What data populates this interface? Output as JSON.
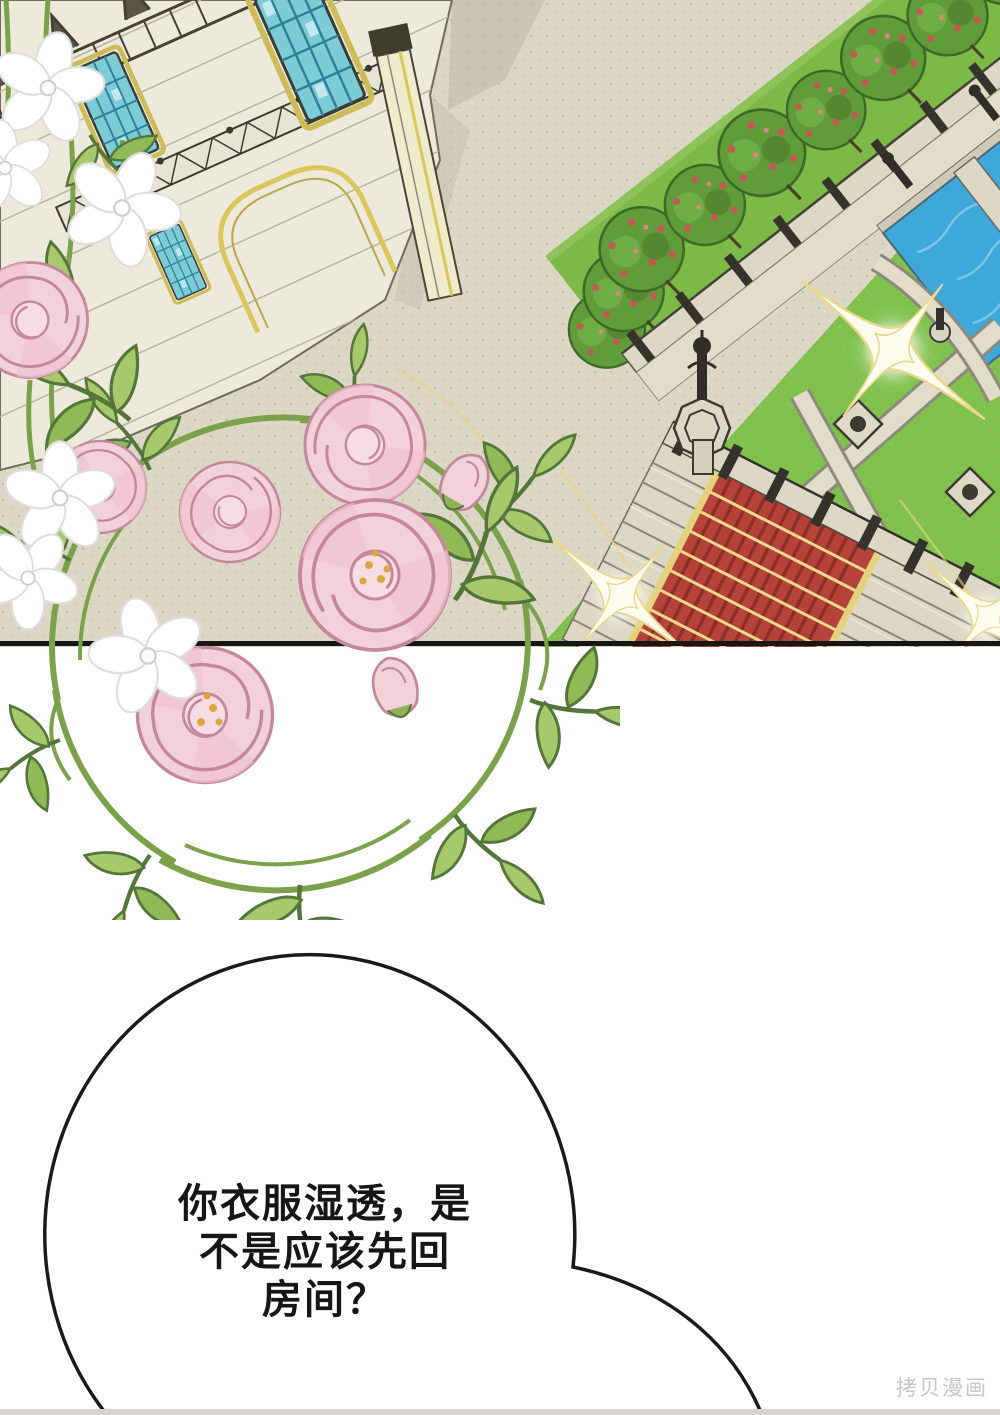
{
  "page": {
    "width": 1000,
    "height": 1415
  },
  "panel": {
    "label": "palace courtyard aerial illustration",
    "elements": [
      "palace-facade",
      "stained-glass-windows",
      "golden-arch",
      "iron-balconies",
      "garden-tree-row",
      "stone-balustrade",
      "promenade",
      "water-pools",
      "lawn-parterre",
      "gravel-paths",
      "planter-diamonds",
      "lamp-pillar",
      "red-carpet-staircase",
      "sparkle-flares",
      "peony-wreath",
      "white-blossoms"
    ]
  },
  "speech_bubble": {
    "lines": [
      "你衣服湿透，是",
      "不是应该先回",
      "房间？"
    ]
  },
  "watermark": {
    "text": "拷贝漫画"
  },
  "colors": {
    "plaza": "#dcd7c5",
    "panel_border": "#161616",
    "grass": "#7cb946",
    "lawn": "#7fc14c",
    "tree": "#619c3b",
    "tree_flower": "#c25a52",
    "pool": "#3fa8da",
    "stone": "#ddd8c6",
    "carpet": "#b5433a",
    "carpet_stripe": "#8d2f28",
    "gold_trim": "#e3d27c",
    "window": "#7bccd6",
    "window_frame": "#cdbd5a",
    "peony": "#f3d1da",
    "peony_outline": "#c4879b",
    "leaf": "#a6c96b",
    "vine": "#7ba24b",
    "sparkle": "#e9d88c",
    "bubble_outline": "#1a1a1a",
    "text": "#161616"
  }
}
